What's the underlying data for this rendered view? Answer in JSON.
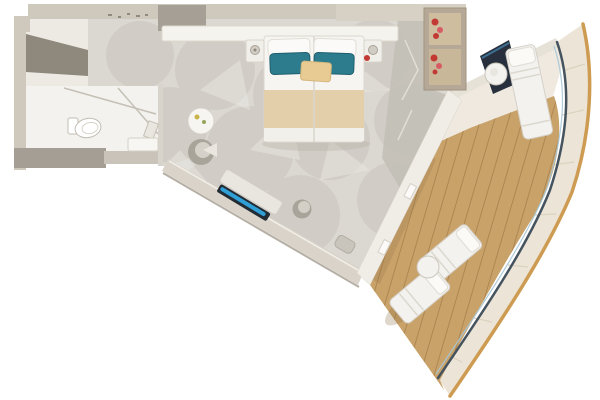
{
  "image": {
    "type": "floor-plan-render",
    "subject": "balcony stateroom, top-down 3D floor plan",
    "background": "#ffffff"
  },
  "rooms": [
    {
      "name": "entrance-corridor"
    },
    {
      "name": "bathroom"
    },
    {
      "name": "bedroom-living-area"
    },
    {
      "name": "balcony"
    }
  ],
  "furniture": [
    "wardrobe",
    "toilet",
    "shower-glass",
    "vanity",
    "double-bed",
    "nightstand-left",
    "nightstand-right",
    "table-lamp-left",
    "table-lamp-right",
    "headboard-console",
    "open-closet-with-clothes",
    "round-side-table",
    "tub-lounge-chair",
    "sofa-console-with-blue-accent",
    "desk-chair",
    "ottoman",
    "balcony-chaise-top",
    "balcony-round-table-top",
    "balcony-chaise-lower-1",
    "balcony-chaise-lower-2",
    "balcony-round-table-lower"
  ],
  "colors": {
    "background": "#ffffff",
    "wall": "#cfc8bd",
    "wall_right": "#d6d0c5",
    "wall_dark": "#a59f95",
    "wardrobe_shadow": "#8f897d",
    "corridor_floor": "#edeae4",
    "bath_floor": "#f4f2ee",
    "bath_wall_bottom": "#a49e94",
    "carpet": "#dbd8d2",
    "carpet_pattern": "#c8c4bc",
    "marble_strip": "#c2beb6",
    "bed_linen": "#f6f5f1",
    "bed_runner": "#e3cfa9",
    "pillow_teal": "#2c7c8e",
    "cushion_beige": "#e8cb92",
    "closet_frame": "#b5a897",
    "closet_interior": "#cfbda0",
    "clothes_red": "#c23a33",
    "clothes_pink": "#d75b63",
    "sofa_navy": "#222b33",
    "sofa_blue": "#2f9fd6",
    "dark_item": "#27303c",
    "deck_wood": "#c9a26a",
    "deck_plank_gap": "#ad8752",
    "deck_shadow": "#8d6f46",
    "railing": "#45535f",
    "glass_hint": "#a6c6d6",
    "hull_band": "#ece4d6",
    "hull_edge": "#cd9b51",
    "furniture_white": "#f3f2ee",
    "furniture_gray": "#a9a49a"
  }
}
